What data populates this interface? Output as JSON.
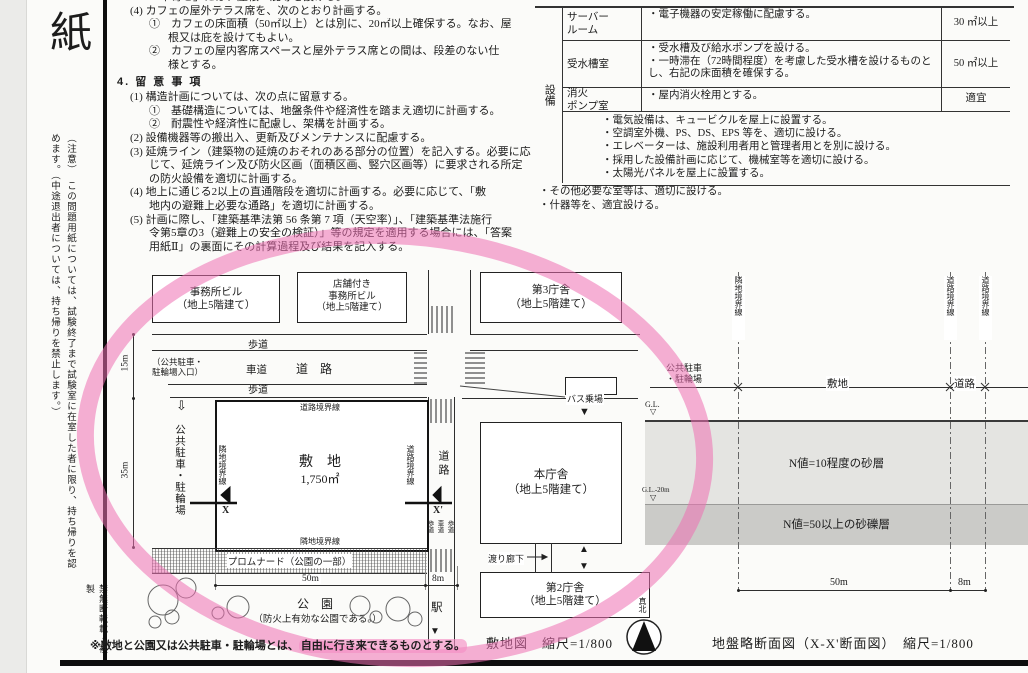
{
  "side": {
    "big_char": "紙",
    "notice": "（注意）　この問題用紙については、試験終了まで試験室に在室した者に限り、持ち帰りを認めます。（中途退出者については、持ち帰りを禁止します。）",
    "footer_note": "禁無断転載・複製"
  },
  "body_text": {
    "lines": [
      {
        "text": "「車寄せ」には、屋根・庇等を設ける。",
        "cls": "ind2 clip"
      },
      {
        "text": "(4) カフェの屋外テラス席を、次のとおり計画する。",
        "cls": "ind1"
      },
      {
        "text": "①　カフェの床面積（50㎡以上）とは別に、20㎡以上確保する。なお、屋",
        "cls": "ind2"
      },
      {
        "text": "根又は庇を設けてもよい。",
        "cls": "ind3"
      },
      {
        "text": "②　カフェの屋内客席スペースと屋外テラス席との間は、段差のない仕",
        "cls": "ind2"
      },
      {
        "text": "様とする。",
        "cls": "ind3"
      },
      {
        "text": "4. 留 意 事 項",
        "cls": "heading"
      },
      {
        "text": "(1) 構造計画については、次の点に留意する。",
        "cls": "ind1"
      },
      {
        "text": "①　基礎構造については、地盤条件や経済性を踏まえ適切に計画する。",
        "cls": "ind2"
      },
      {
        "text": "②　耐震性や経済性に配慮し、架構を計画する。",
        "cls": "ind2"
      },
      {
        "text": "(2) 設備機器等の搬出入、更新及びメンテナンスに配慮する。",
        "cls": "ind1"
      },
      {
        "text": "(3) 延焼ライン（建築物の延焼のおそれのある部分の位置）を記入する。必要に応",
        "cls": "ind1"
      },
      {
        "text": "じて、延焼ライン及び防火区画（面積区画、竪穴区画等）に要求される所定",
        "cls": "ind2"
      },
      {
        "text": "の防火設備を適切に計画する。",
        "cls": "ind2"
      },
      {
        "text": "(4) 地上に通じる2以上の直通階段を適切に計画する。必要に応じて、「敷",
        "cls": "ind1"
      },
      {
        "text": "地内の避難上必要な通路」を適切に計画する。",
        "cls": "ind2"
      },
      {
        "text": "(5) 計画に際し、「建築基準法第 56 条第 7 項（天空率）」、「建築基準法施行",
        "cls": "ind1"
      },
      {
        "text": "令第5章の3（避難上の安全の検証）」等の規定を適用する場合には、「答案",
        "cls": "ind2"
      },
      {
        "text": "用紙Ⅱ」の裏面にその計算過程及び結果を記入する。",
        "cls": "ind2"
      }
    ]
  },
  "table": {
    "group_label": "設備",
    "rows": [
      {
        "room": "サーバー\nルーム",
        "desc": "・電子機器の安定稼働に配慮する。",
        "area": "30 ㎡以上",
        "cls": "r1"
      },
      {
        "room": "受水槽室",
        "desc": "・受水槽及び給水ポンプを設ける。\n・一時滞在（72時間程度）を考慮した受水槽を設けるものとし、右記の床面積を確保する。",
        "area": "50 ㎡以上",
        "cls": "r2"
      },
      {
        "room": "消火\nポンプ室",
        "desc": "・屋内消火栓用とする。",
        "area": "適宜",
        "cls": "r3"
      }
    ],
    "equipment_notes": [
      "・電気設備は、キュービクルを屋上に設置する。",
      "・空調室外機、PS、DS、EPS 等を、適切に設ける。",
      "・エレベーターは、施設利用者用と管理者用とを別に設ける。",
      "・採用した設備計画に応じて、機械室等を適切に設ける。",
      "・太陽光パネルを屋上に設置する。"
    ],
    "footer_notes": [
      "・その他必要な室等は、適切に設ける。",
      "・什器等を、適宜設ける。"
    ]
  },
  "plan": {
    "bldg_office": "事務所ビル\n（地上5階建て）",
    "bldg_shop_office": "店舗付き\n事務所ビル\n（地上5階建て）",
    "bldg_gov3": "第3庁舎\n（地上5階建て）",
    "bldg_main_gov": "本庁舎\n（地上5階建て）",
    "bldg_gov2": "第2庁舎\n（地上5階建て）",
    "sidewalk_top": "歩道",
    "sidewalk_mid": "歩道",
    "roadway": "車道",
    "road_horizontal": "道　路",
    "road_vertical": "道路",
    "parking_entrance": "（公共駐車・\n駐輪場入口）",
    "parking_vertical": "公共駐車・駐輪場",
    "parking_arrow": "⇩",
    "boundary_road_top": "道路境界線",
    "boundary_road_right": "道路境界線",
    "boundary_adjacent_left": "隣地境界線",
    "boundary_adjacent_bottom": "隣地境界線",
    "site_name": "敷　地",
    "site_area": "1,750㎡",
    "dim_15m": "15m",
    "dim_35m": "35m",
    "dim_50m": "50m",
    "dim_8m": "8m",
    "section_x": "X",
    "section_x2": "X'",
    "promenade": "プロムナード（公園の一部）",
    "bus_stop": "バス乗場",
    "corridor": "渡り廊下",
    "park": "公　園",
    "park_note": "（防火上有効な公園である。）",
    "station": "駅",
    "lane_left": "歩道",
    "lane_mid": "車道",
    "lane_right": "歩道",
    "marker_down1": "▼",
    "marker_down2": "▼",
    "marker_up": "▲",
    "marker_station": "▼"
  },
  "section": {
    "boundary_adjacent": "隣地境界線",
    "boundary_road1": "道路境界線",
    "boundary_road2": "道路境界線",
    "parking": "公共駐車\n・駐輪場",
    "site": "敷地",
    "road": "道路",
    "gl": "G.L.",
    "gl_mark1": "▽",
    "gl_minus20": "G.L.-20m",
    "gl_mark2": "▽",
    "layer_sand": "N値=10程度の砂層",
    "layer_gravel": "N値=50以上の砂礫層",
    "dim_50m": "50m",
    "dim_8m": "8m"
  },
  "captions": {
    "site_map": "敷地図　縮尺=1/800",
    "north": "真北",
    "section_map": "地盤略断面図（X-X'断面図）　縮尺=1/800"
  },
  "footnote": {
    "prefix": "※敷地と公園又は公共駐車・駐輪場とは、",
    "highlight": "自由に行き来できるものとする。"
  },
  "annotation": {
    "circle_color": "#ef6fb2",
    "highlight_color": "#f48fc5"
  }
}
